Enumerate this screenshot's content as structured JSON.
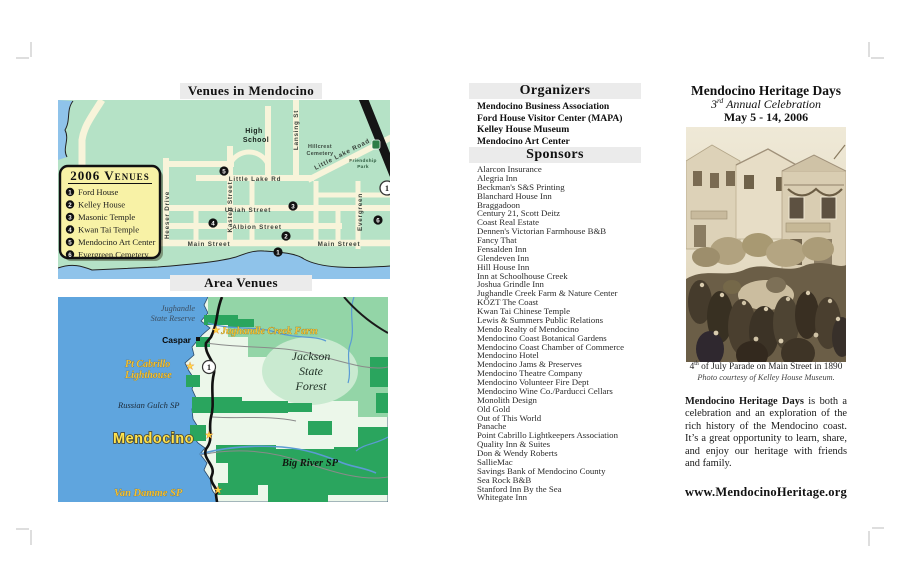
{
  "colors": {
    "ocean": "#5fa5de",
    "ocean_light": "#8fc3ea",
    "land_light": "#ecf7ea",
    "land_mid": "#93d5a7",
    "land_dark": "#2aa55e",
    "map_green": "#b5e2c6",
    "street_cream": "#f8f4da",
    "legend_yellow": "#f8f2a6",
    "label_yellow": "#f2c136",
    "mendocino_yellow": "#ffe34d",
    "header_bar_gray": "#ebebeb",
    "highway_black": "#151515"
  },
  "left_panel": {
    "map1": {
      "title": "Venues in Mendocino",
      "legend": {
        "title": "2006 Venues",
        "items": [
          {
            "num": "1",
            "label": "Ford House"
          },
          {
            "num": "2",
            "label": "Kelley House"
          },
          {
            "num": "3",
            "label": "Masonic Temple"
          },
          {
            "num": "4",
            "label": "Kwan Tai Temple"
          },
          {
            "num": "5",
            "label": "Mendocino Art Center"
          },
          {
            "num": "6",
            "label": "Evergreen Cemetery"
          }
        ]
      },
      "street_labels": {
        "heeser": "Heeser Drive",
        "kasten": "Kasten Street",
        "lansing": "Lansing St",
        "evergreen": "Evergreen",
        "little_lake_rd": "Little Lake Rd",
        "little_lake_road": "Little Lake Road",
        "ukiah": "Ukiah Street",
        "albion": "Albion Street",
        "main": "Main Street",
        "high_school_1": "High",
        "high_school_2": "School",
        "hillcrest_1": "Hillcrest",
        "hillcrest_2": "Cemetery",
        "friendship_1": "Friendship",
        "friendship_2": "Park",
        "hwy_shield": "1"
      }
    },
    "map2": {
      "title": "Area Venues",
      "labels": {
        "jughandle_reserve_1": "Jughandle",
        "jughandle_reserve_2": "State Reserve",
        "jughandle_farm": "Jughandle Creek Farm",
        "caspar": "Caspar",
        "pt_cabrillo_1": "Pt Cabrillo",
        "pt_cabrillo_2": "Lighthouse",
        "jackson_1": "Jackson",
        "jackson_2": "State",
        "jackson_3": "Forest",
        "russian_gulch": "Russian Gulch SP",
        "mendocino": "Mendocino",
        "big_river": "Big River SP",
        "van_damme": "Van Damme SP",
        "hwy_shield": "1"
      }
    }
  },
  "middle_panel": {
    "organizers": {
      "header": "Organizers",
      "items": [
        "Mendocino Business Association",
        "Ford House Visitor Center (MAPA)",
        "Kelley House Museum",
        "Mendocino Art Center"
      ]
    },
    "sponsors": {
      "header": "Sponsors",
      "items": [
        "Alarcon Insurance",
        "Alegria Inn",
        "Beckman's S&S Printing",
        "Blanchard House Inn",
        "Braggadoon",
        "Century 21, Scott Deitz",
        "Coast Real Estate",
        "Dennen's Victorian Farmhouse B&B",
        "Fancy That",
        "Fensalden Inn",
        "Glendeven Inn",
        "Hill House Inn",
        "Inn at Schoolhouse Creek",
        "Joshua Grindle Inn",
        "Jughandle Creek Farm & Nature Center",
        "KÖZT The Coast",
        "Kwan Tai Chinese Temple",
        "Lewis & Summers Public Relations",
        "Mendo Realty of Mendocino",
        "Mendocino Coast Botanical Gardens",
        "Mendocino Coast Chamber  of Commerce",
        "Mendocino Hotel",
        "Mendocino Jams & Preserves",
        "Mendocino Theatre Company",
        "Mendocino Volunteer Fire Dept",
        "Mendocino Wine Co./Parducci Cellars",
        "Monolith Design",
        "Old Gold",
        "Out of This World",
        "Panache",
        "Point Cabrillo Lightkeepers Association",
        "Quality Inn & Suites",
        "Don & Wendy Roberts",
        "SallieMac",
        "Savings Bank of Mendocino County",
        "Sea Rock B&B",
        "Stanford Inn By the Sea",
        "Whitegate Inn"
      ]
    }
  },
  "right_panel": {
    "title": "Mendocino Heritage Days",
    "subtitle_num": "3",
    "subtitle_sup": "rd",
    "subtitle_rest": " Annual Celebration",
    "date_line": "May 5 - 14, 2006",
    "caption_num": "4",
    "caption_sup": "th",
    "caption_rest": " of July Parade on Main Street in 1890",
    "photo_credit": "Photo courtesy of Kelley House Museum.",
    "para_lead": "Mendocino Heritage Days",
    "para_rest": " is both a celebration and an exploration of the rich history of the Mendocino coast. It’s a great opportunity to learn, share, and enjoy our heritage with friends and family.",
    "url": "www.MendocinoHeritage.org"
  }
}
